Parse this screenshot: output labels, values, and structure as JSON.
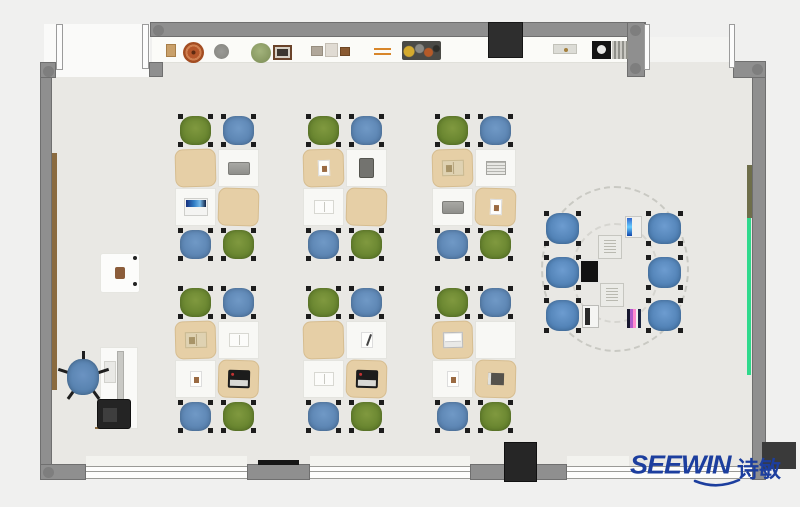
{
  "branding": {
    "logo_text": "SEEWIN",
    "logo_cjk": "诗敏",
    "logo_color": "#1c3e9e"
  },
  "palette": {
    "outside": "#f0f0ef",
    "floor": "#e9e8e4",
    "wall": "#8f8f8f",
    "wall_border": "#6f6f6f",
    "counter": "#fbfbf8",
    "desk_white": "#f8f8f5",
    "desk_tan": "#e6cfa6",
    "chair_green": "#66832e",
    "chair_blue": "#5a83b1",
    "pod_chair_blue": "#4f80b4",
    "teacher_chair_blue": "#5580ad",
    "brown_board": "#8a6b40",
    "green_board": "#2fd98c",
    "olive_board": "#6e6e4a",
    "dark_cabinet": "#262626"
  },
  "clusters": [
    {
      "id": "cluster-1",
      "chairs_top": [
        "green",
        "blue"
      ],
      "chairs_bottom": [
        "blue",
        "green"
      ],
      "desks": [
        {
          "cover": "tan",
          "item": null
        },
        {
          "cover": "white",
          "item": "laptop-closed"
        },
        {
          "cover": "white",
          "item": "laptop-open-blue"
        },
        {
          "cover": "tan",
          "item": null
        }
      ]
    },
    {
      "id": "cluster-2",
      "chairs_top": [
        "green",
        "blue"
      ],
      "chairs_bottom": [
        "blue",
        "green"
      ],
      "desks": [
        {
          "cover": "tan",
          "item": "paper"
        },
        {
          "cover": "white",
          "item": "tablet-dark"
        },
        {
          "cover": "white",
          "item": "book-open"
        },
        {
          "cover": "tan",
          "item": null
        }
      ]
    },
    {
      "id": "cluster-3",
      "chairs_top": [
        "green",
        "blue"
      ],
      "chairs_bottom": [
        "blue",
        "green"
      ],
      "desks": [
        {
          "cover": "tan",
          "item": "book-open-tan"
        },
        {
          "cover": "white",
          "item": "notebook"
        },
        {
          "cover": "white",
          "item": "laptop-closed"
        },
        {
          "cover": "tan",
          "item": "paper"
        }
      ]
    },
    {
      "id": "cluster-4",
      "chairs_top": [
        "green",
        "blue"
      ],
      "chairs_bottom": [
        "blue",
        "green"
      ],
      "desks": [
        {
          "cover": "tan",
          "item": "book-open-tan"
        },
        {
          "cover": "white",
          "item": "book-open"
        },
        {
          "cover": "white",
          "item": "paper"
        },
        {
          "cover": "tan",
          "item": "laptop-open-black"
        }
      ]
    },
    {
      "id": "cluster-5",
      "chairs_top": [
        "green",
        "blue"
      ],
      "chairs_bottom": [
        "blue",
        "green"
      ],
      "desks": [
        {
          "cover": "tan",
          "item": null
        },
        {
          "cover": "white",
          "item": "paper-pen"
        },
        {
          "cover": "white",
          "item": "book-open"
        },
        {
          "cover": "tan",
          "item": "laptop-open-black"
        }
      ]
    },
    {
      "id": "cluster-6",
      "chairs_top": [
        "green",
        "blue"
      ],
      "chairs_bottom": [
        "blue",
        "green"
      ],
      "desks": [
        {
          "cover": "tan",
          "item": "laptop-open-silver"
        },
        {
          "cover": "white",
          "item": null
        },
        {
          "cover": "white",
          "item": "paper"
        },
        {
          "cover": "tan",
          "item": "book-dark"
        }
      ]
    }
  ],
  "pod": {
    "chair_count": 6,
    "chair_color": "pod",
    "devices": [
      "monitor-blue",
      "sketch-box",
      "tv-black",
      "sketch-box",
      "laptop-silver",
      "phone-screen"
    ]
  },
  "teacher_area": {
    "items": [
      "side-table",
      "desk",
      "monitor",
      "keyboard",
      "office-chair",
      "printer"
    ]
  },
  "shelf": {
    "items": [
      "box-tan",
      "pot-terracotta",
      "plate-gray",
      "plant-green",
      "photo-frame",
      "box-small-1",
      "box-small-2",
      "box-small-3",
      "chopsticks",
      "fruit-tray",
      "black-cabinet",
      "tray-small",
      "black-box-circle",
      "slat-rack"
    ]
  }
}
